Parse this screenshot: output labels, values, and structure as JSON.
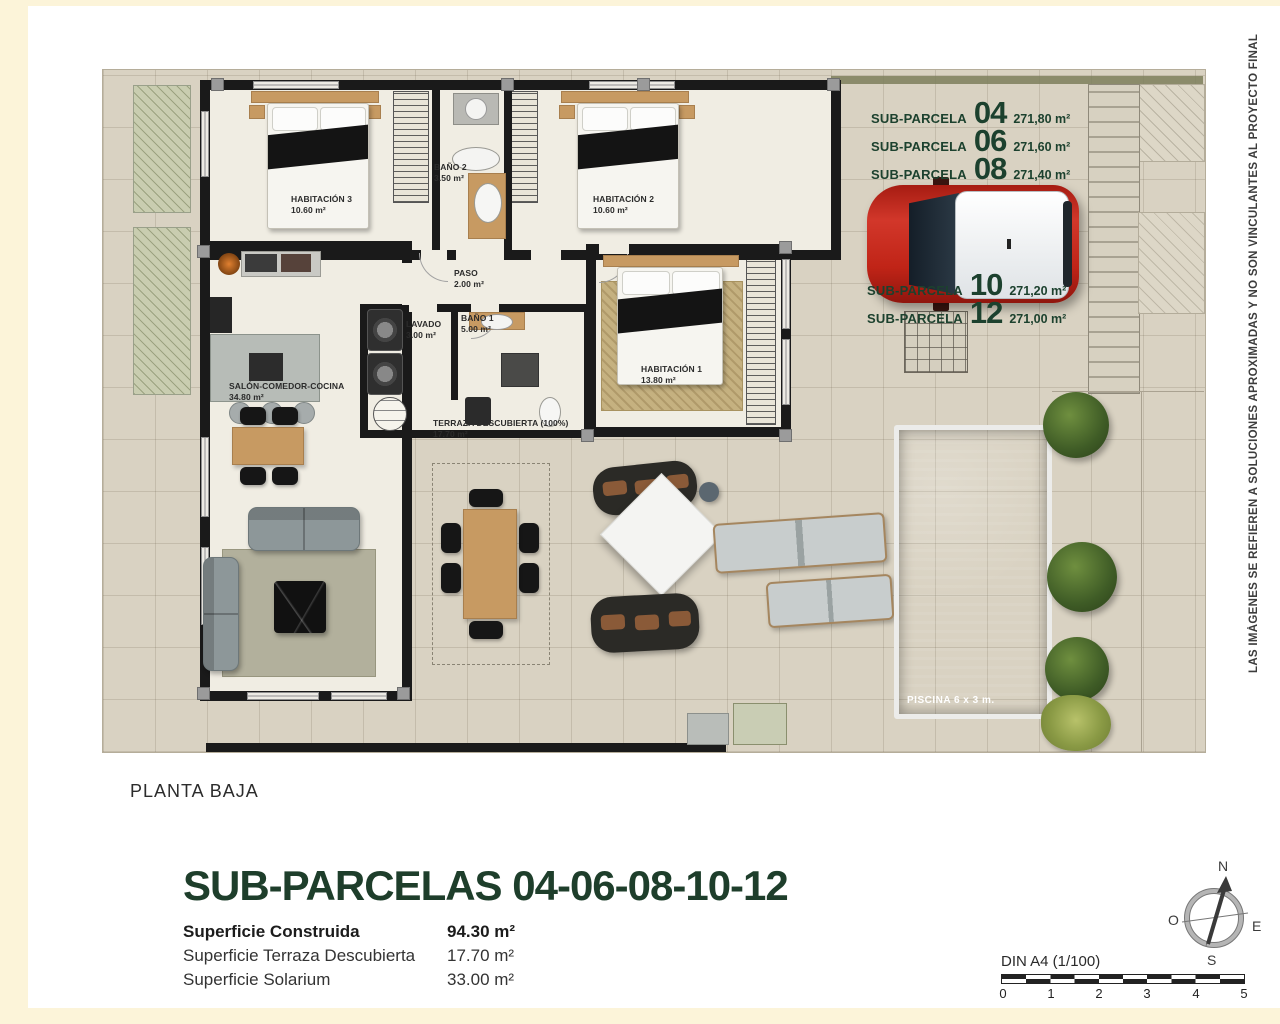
{
  "page": {
    "floor_label": "PLANTA BAJA",
    "disclaimer": "LAS IMÁGENES SE REFIEREN A SOLUCIONES APROXIMADAS Y NO SON VINCULANTES AL PROYECTO FINAL"
  },
  "subparcelas": {
    "prefix": "SUB-PARCELA",
    "groups": [
      [
        {
          "number": "04",
          "area": "271,80 m²"
        },
        {
          "number": "06",
          "area": "271,60 m²"
        },
        {
          "number": "08",
          "area": "271,40 m²"
        }
      ],
      [
        {
          "number": "10",
          "area": "271,20 m²"
        },
        {
          "number": "12",
          "area": "271,00 m²"
        }
      ]
    ]
  },
  "rooms": {
    "habitacion3": {
      "name": "HABITACIÓN 3",
      "area": "10.60 m²"
    },
    "bano2": {
      "name": "BAÑO 2",
      "area": "3.50 m²"
    },
    "habitacion2": {
      "name": "HABITACIÓN 2",
      "area": "10.60 m²"
    },
    "paso": {
      "name": "PASO",
      "area": "2.00 m²"
    },
    "lavado": {
      "name": "LAVADO",
      "area": "3.00 m²"
    },
    "bano1": {
      "name": "BAÑO 1",
      "area": "5.00 m²"
    },
    "habitacion1": {
      "name": "HABITACIÓN 1",
      "area": "13.80 m²"
    },
    "salon": {
      "name": "SALÓN-COMEDOR-COCINA",
      "area": "34.80 m²"
    },
    "terraza": {
      "name": "TERRAZA DESCUBIERTA (100%)",
      "area": "17.70 m²"
    }
  },
  "pool": {
    "label": "PISCINA 6 x 3 m."
  },
  "summary": {
    "title": "SUB-PARCELAS 04-06-08-10-12",
    "rows": [
      {
        "label": "Superficie Construida",
        "value": "94.30 m²"
      },
      {
        "label": "Superficie Terraza Descubierta",
        "value": "17.70 m²"
      },
      {
        "label": "Superficie Solarium",
        "value": "33.00 m²"
      }
    ]
  },
  "compass": {
    "north": "N",
    "south": "S",
    "east": "E",
    "west": "O"
  },
  "scalebar": {
    "label": "DIN A4 (1/100)",
    "ticks": [
      "0",
      "1",
      "2",
      "3",
      "4",
      "5"
    ]
  },
  "colors": {
    "accent_green": "#1c412e",
    "wall": "#1a1a1a",
    "pool_blue": "#3e6ba0",
    "car_red": "#c22a1a",
    "tile": "#d9d2c2",
    "cream": "#fcf4d9"
  }
}
